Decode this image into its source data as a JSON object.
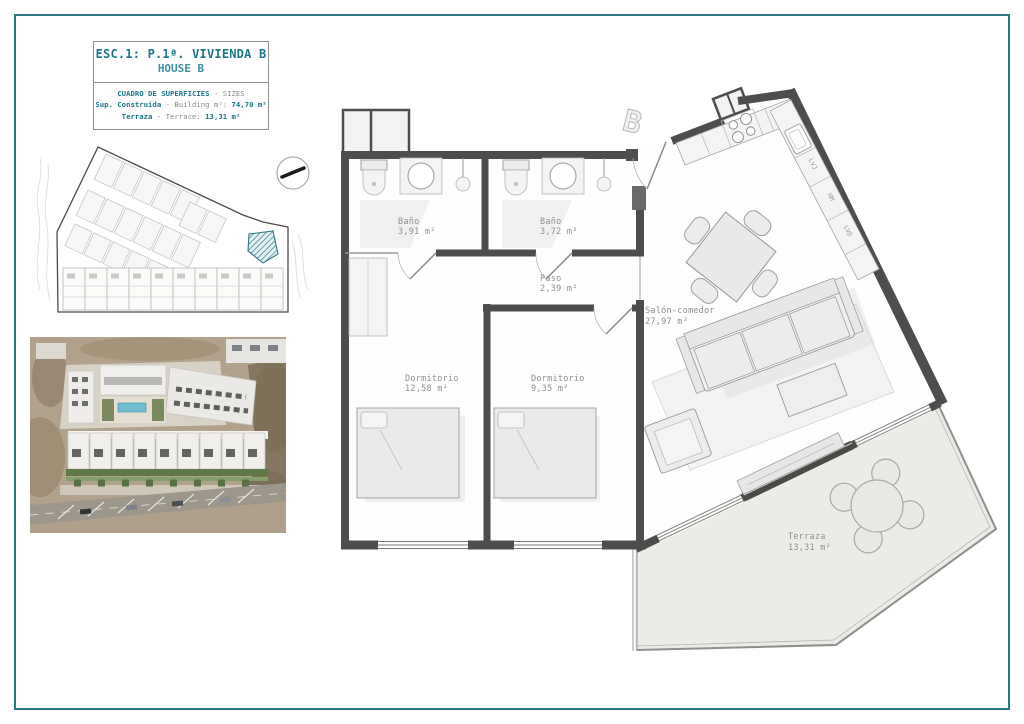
{
  "page": {
    "border_color": "#2a7886",
    "sheet_type": "floor-plan sheet"
  },
  "title_block": {
    "title": "ESC.1: P.1ª. VIVIENDA B",
    "subtitle": "HOUSE B",
    "sizes_header_strong": "CUADRO DE SUPERFICIES",
    "sizes_header_rest": " - SIZES",
    "built_label": "Sup. Construida",
    "built_mid": " - Building m²: ",
    "built_value": "74,70 m²",
    "terrace_label": "Terraza",
    "terrace_mid": " - Terrace: ",
    "terrace_value": "13,31 m²"
  },
  "site_plan": {
    "highlighted_plot_color": "#2f7d8e"
  },
  "floor_plan": {
    "unit_marker": "B",
    "rooms": [
      {
        "name": "Baño",
        "area": "3,91 m²"
      },
      {
        "name": "Baño",
        "area": "3,72 m²"
      },
      {
        "name": "Paso",
        "area": "2,39 m²"
      },
      {
        "name": "Dormitorio",
        "area": "12,58 m²"
      },
      {
        "name": "Dormitorio",
        "area": "9,35 m²"
      },
      {
        "name": "Salón-comedor",
        "area": "27,97 m²"
      },
      {
        "name": "Terraza",
        "area": "13,31 m²"
      }
    ],
    "kitchen_appliances": [
      "LVJ",
      "HM",
      "LVD"
    ]
  }
}
